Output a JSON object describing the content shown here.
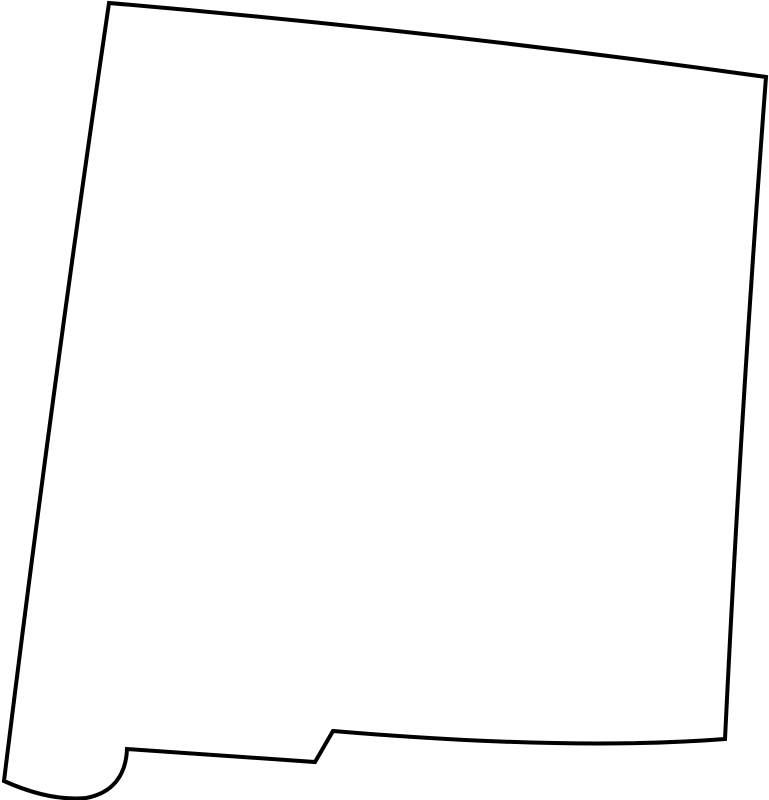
{
  "page": {
    "background_color": "#ffffff"
  },
  "map": {
    "region_name": "New Mexico",
    "kind": "blank-state-outline",
    "canvas": {
      "width": 769,
      "height": 800
    },
    "stroke_color": "#000000",
    "fill_color": "#ffffff",
    "stroke_width": 4,
    "outline_path": "M 109,3 Q 437,31 766,77 Q 741,408 725,739 Q 571,751 333,731 L 315,762 L 127,749 C 126,775 113,793 86,798 C 54,801 24,790 4,781 Q 52,391 109,3 Z"
  }
}
